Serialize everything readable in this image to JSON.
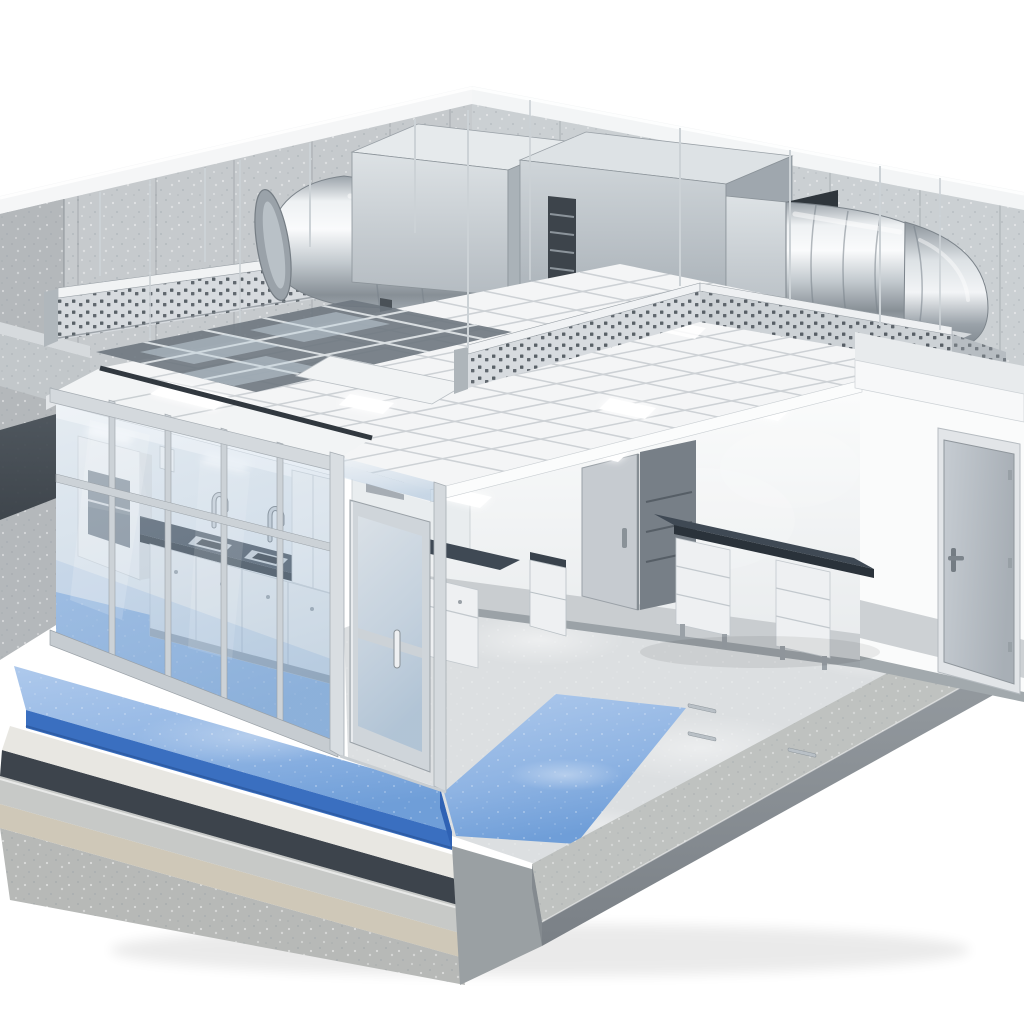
{
  "scene": {
    "description": "Isometric cutaway 3D rendering of a laboratory cleanroom building section: concrete shell walls, rooftop HVAC air-handling units with round spiral ducts, perforated cable trays and hanger rods above a suspended white tile ceiling (partially cut away to show the grid), a glass-partitioned lab with benches, sinks and a fume hood, desks with drawer pedestals, interior doors, a steel exterior door, glossy gray epoxy flooring with a blue epoxy walkway, and a stepped cross-section of the floor construction layers at the lower left.",
    "style": "photorealistic architectural illustration, no text labels",
    "background": "white"
  },
  "colors": {
    "background": "#ffffff",
    "concrete": "#c6cacd",
    "concreteDark": "#b4b8bb",
    "concreteLight": "#d6dadd",
    "cap": "#f5f6f7",
    "plenumDark": "#3c434b",
    "plenumMid": "#5a636b",
    "metalLight": "#eef1f3",
    "metalMid": "#c2c9ce",
    "metal": "#b9c0c6",
    "metalDark": "#878f96",
    "galvanized": "#ccd2d6",
    "trayMetal": "#d7dbdf",
    "ceiling": "#f4f5f6",
    "ceilingSeam": "#c6cbcf",
    "gridDark": "#6e7780",
    "wallWhite": "#f7f8f9",
    "wainscot": "#c9cdd0",
    "baseStrip": "#9ba2a7",
    "doorGray": "#b9bfc5",
    "benchTop": "#3f4954",
    "benchEdge": "#2a323a",
    "cabinetWhite": "#eef0f2",
    "frameAluminum": "#ccd2d7",
    "glassTint": "#a9c3dd",
    "floorGray": "#dcdfe1",
    "floorBlue": "#8fb4e3",
    "floorBlueDeep": "#6f9ed8",
    "blueTrim": "#3a6fc0",
    "membrane": "#3d444c",
    "screed": "#e8e7e2",
    "beige": "#cfc8b8",
    "curb": "#bfc2c0",
    "curbFace": "#8a9096",
    "glow": "#ffffff"
  },
  "components": [
    "concrete-shell-walls",
    "hvac-air-handling-units",
    "round-spiral-ducts",
    "perforated-cable-trays",
    "hanger-rods",
    "suspended-ceiling-tiles",
    "ceiling-grid-cutaway",
    "recessed-light-panels",
    "glass-partition-wall",
    "glass-door",
    "lab-bench-with-sinks",
    "fume-hood",
    "desks-with-pedestals",
    "interior-doors",
    "exterior-steel-door",
    "gray-epoxy-floor",
    "blue-epoxy-walkway",
    "floor-construction-layers",
    "concrete-curb"
  ]
}
